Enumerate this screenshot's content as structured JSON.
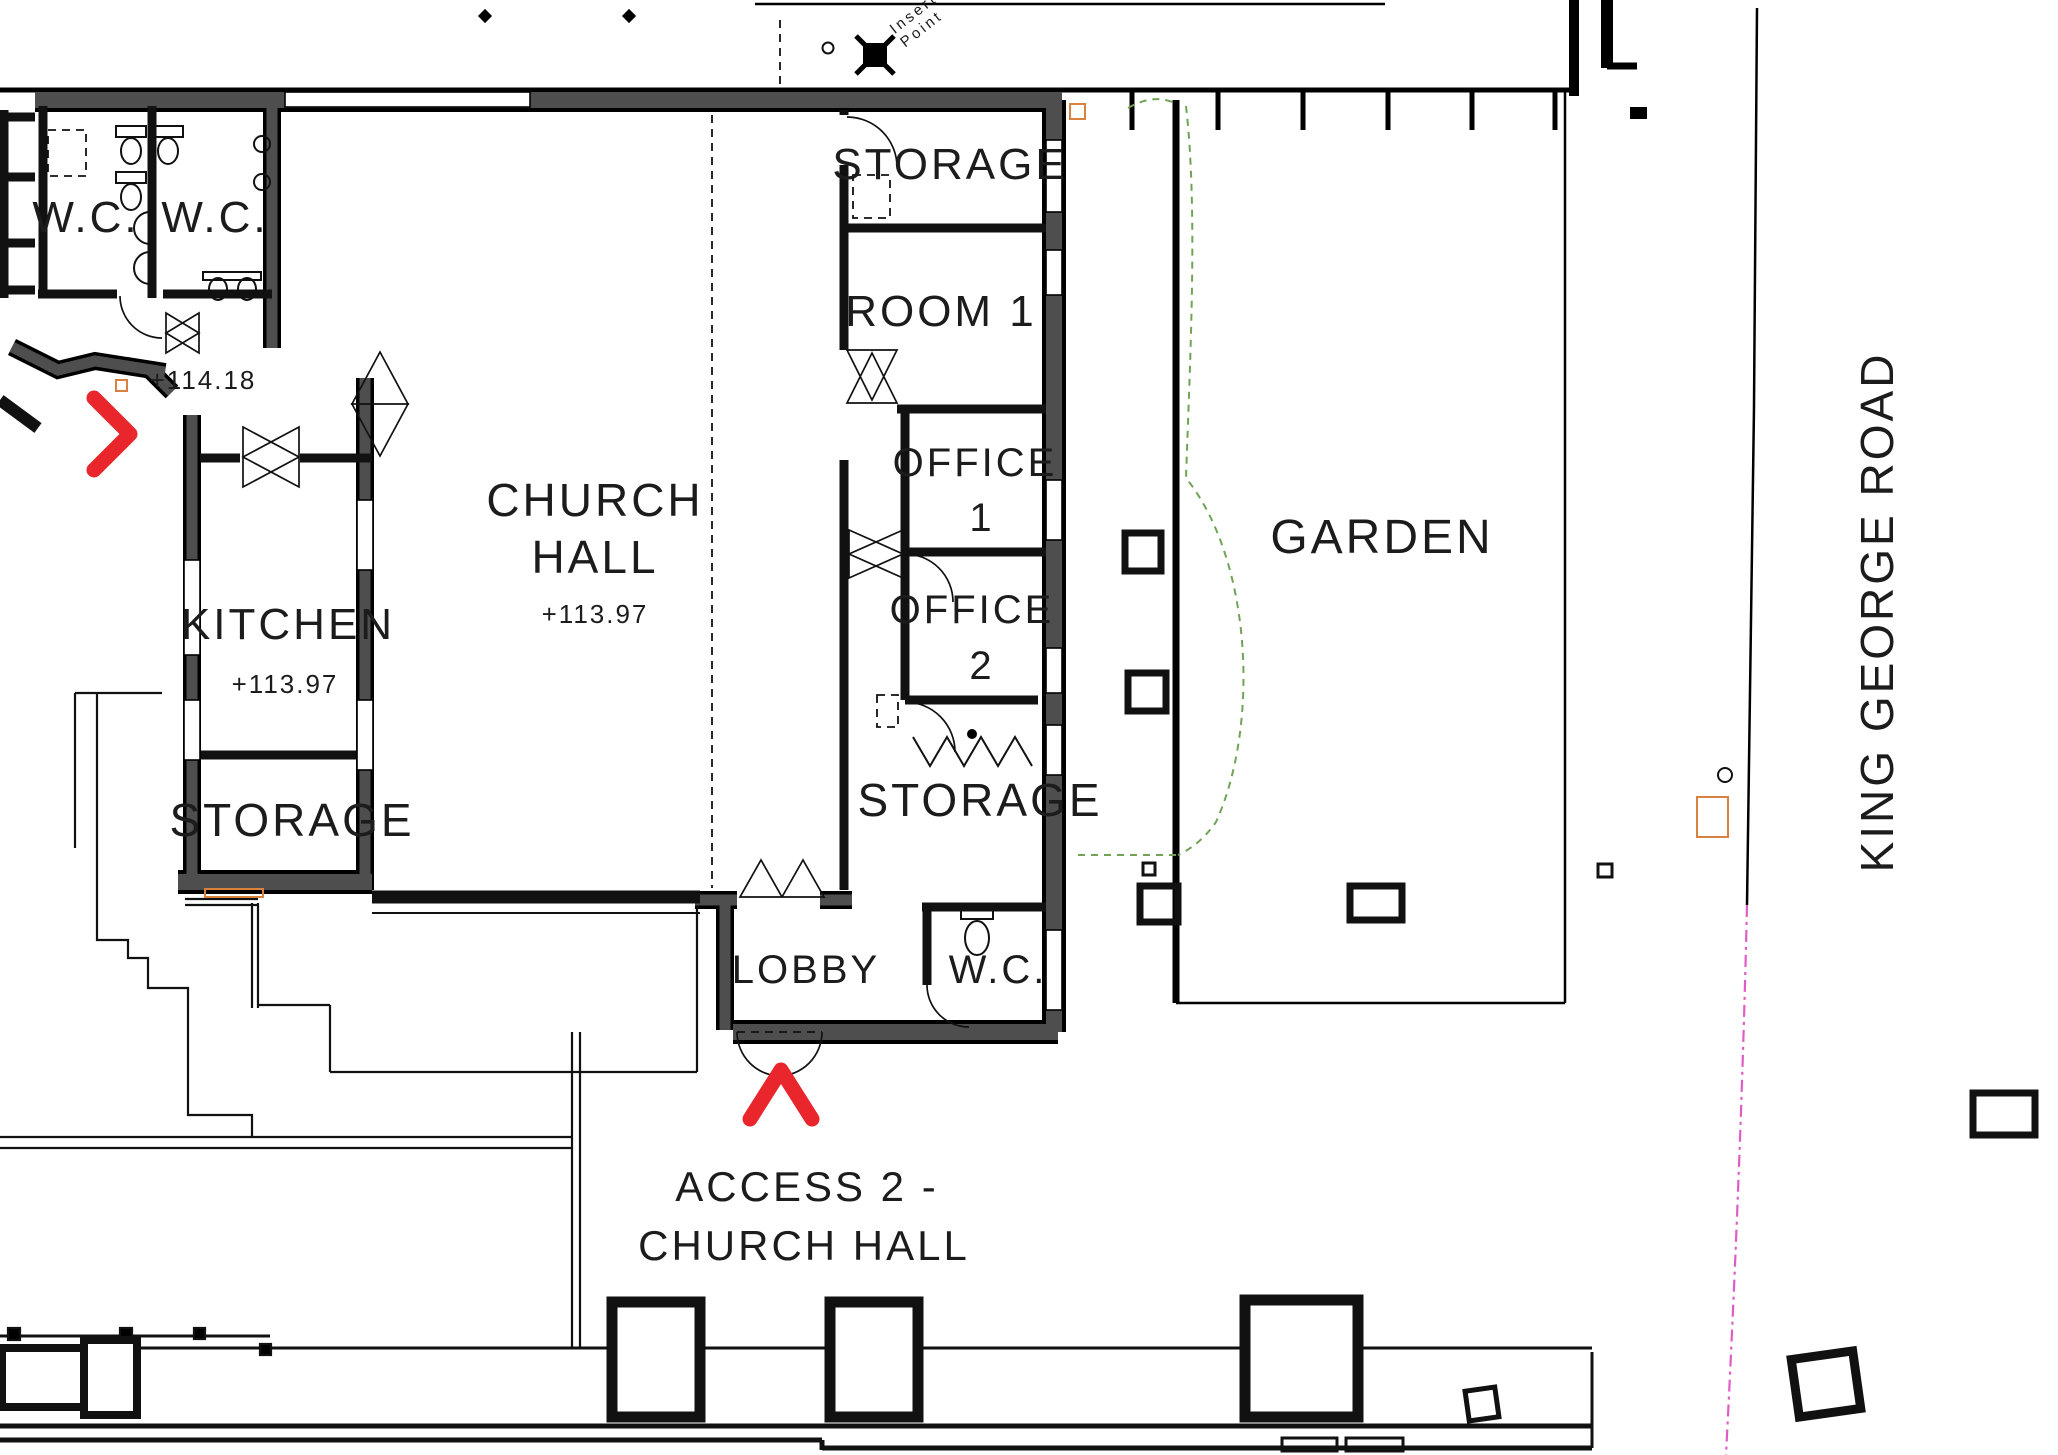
{
  "plan_labels": {
    "wc_left": "W.C.",
    "wc_middle": "W.C.",
    "wc_lobby": "W.C.",
    "church_hall_line1": "CHURCH",
    "church_hall_line2": "HALL",
    "church_hall_level": "+113.97",
    "kitchen": "KITCHEN",
    "kitchen_level": "+113.97",
    "storage_west": "STORAGE",
    "storage_north": "STORAGE",
    "storage_east": "STORAGE",
    "room1": "ROOM 1",
    "office1_line1": "OFFICE",
    "office1_line2": "1",
    "office2_line1": "OFFICE",
    "office2_line2": "2",
    "lobby": "LOBBY",
    "entrance_level": "+114.18",
    "garden": "GARDEN",
    "road": "KING GEORGE ROAD",
    "access_line1": "ACCESS 2 -",
    "access_line2": "CHURCH HALL",
    "insertion_line1": "Insertion",
    "insertion_line2": "Point"
  },
  "colors": {
    "wall_grey": "#4e4e4e",
    "accent_red": "#e8262c",
    "hedge_green": "#71a356",
    "boundary_magenta": "#e05cc5",
    "marker_orange": "#d9823f"
  }
}
